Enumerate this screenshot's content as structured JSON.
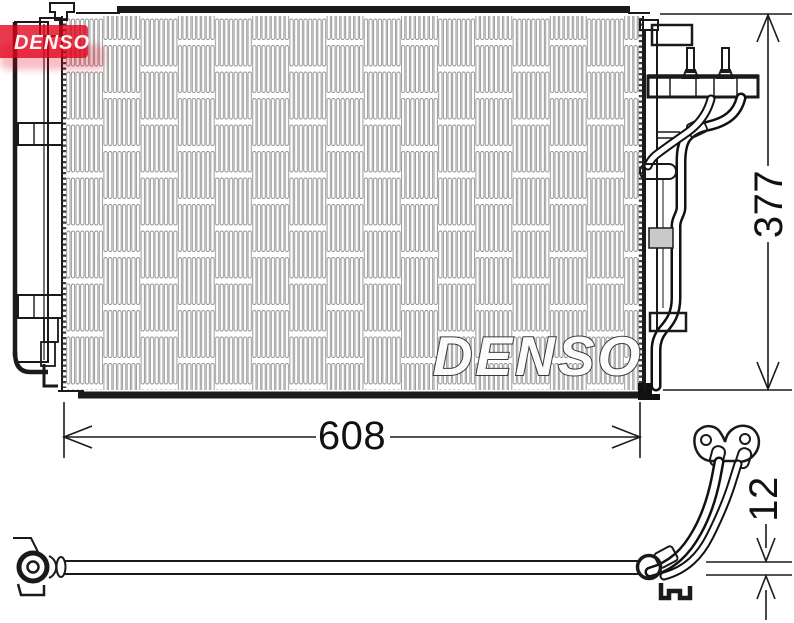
{
  "drawing": {
    "logo": {
      "text": "DENSO"
    },
    "watermark": {
      "text": "DENSO"
    },
    "dimensions": {
      "width": "608",
      "height": "377",
      "pipe_diameter": "12"
    },
    "colors": {
      "brand_red": "#e2001a",
      "line_black": "#1a1a1a",
      "fin_gray": "#8f8f8f",
      "fitting_gray": "#c9c9c9"
    }
  }
}
